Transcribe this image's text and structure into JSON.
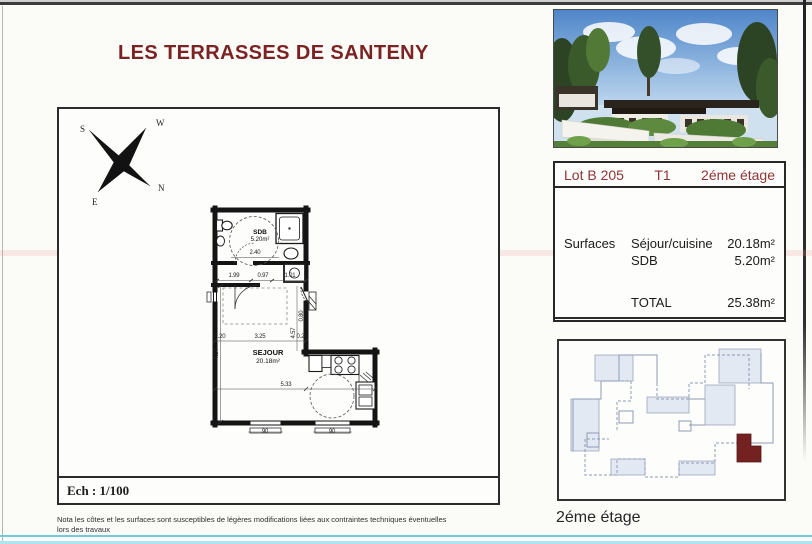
{
  "page": {
    "title": "LES TERRASSES DE SANTENY"
  },
  "compass": {
    "north": "N",
    "south": "S",
    "east": "E",
    "west": "W"
  },
  "plan": {
    "scale_label": "Ech : 1/100",
    "rooms": {
      "sdb": {
        "name": "SDB",
        "area": "5.20m²"
      },
      "sejour": {
        "name": "SEJOUR",
        "area": "20.18m²"
      }
    },
    "dims": {
      "hall_a": "1.99",
      "hall_b": "0.97",
      "hall_c": "1.01",
      "sdb_width": "2.40",
      "wall_left": "0.20",
      "sejour_width": "3.25",
      "wall_right": "0.20",
      "height_left": "4.54",
      "height_right": "4.57",
      "door": "0.80",
      "sejour_bottom": "5.33",
      "window_a": "90",
      "window_b": "90"
    }
  },
  "lot_table": {
    "lot": "Lot B 205",
    "type": "T1",
    "floor": "2éme étage",
    "surfaces_label": "Surfaces",
    "rows": [
      {
        "label": "Séjour/cuisine",
        "value": "20.18m²"
      },
      {
        "label": "SDB",
        "value": "5.20m²"
      }
    ],
    "total_label": "TOTAL",
    "total_value": "25.38m²"
  },
  "key_plan": {
    "caption": "2éme étage"
  },
  "note": {
    "line1": "Nota  les côtes et les surfaces sont susceptibles de légères modifications liées aux contraintes techniques éventuelles",
    "line2": "lors des travaux"
  }
}
